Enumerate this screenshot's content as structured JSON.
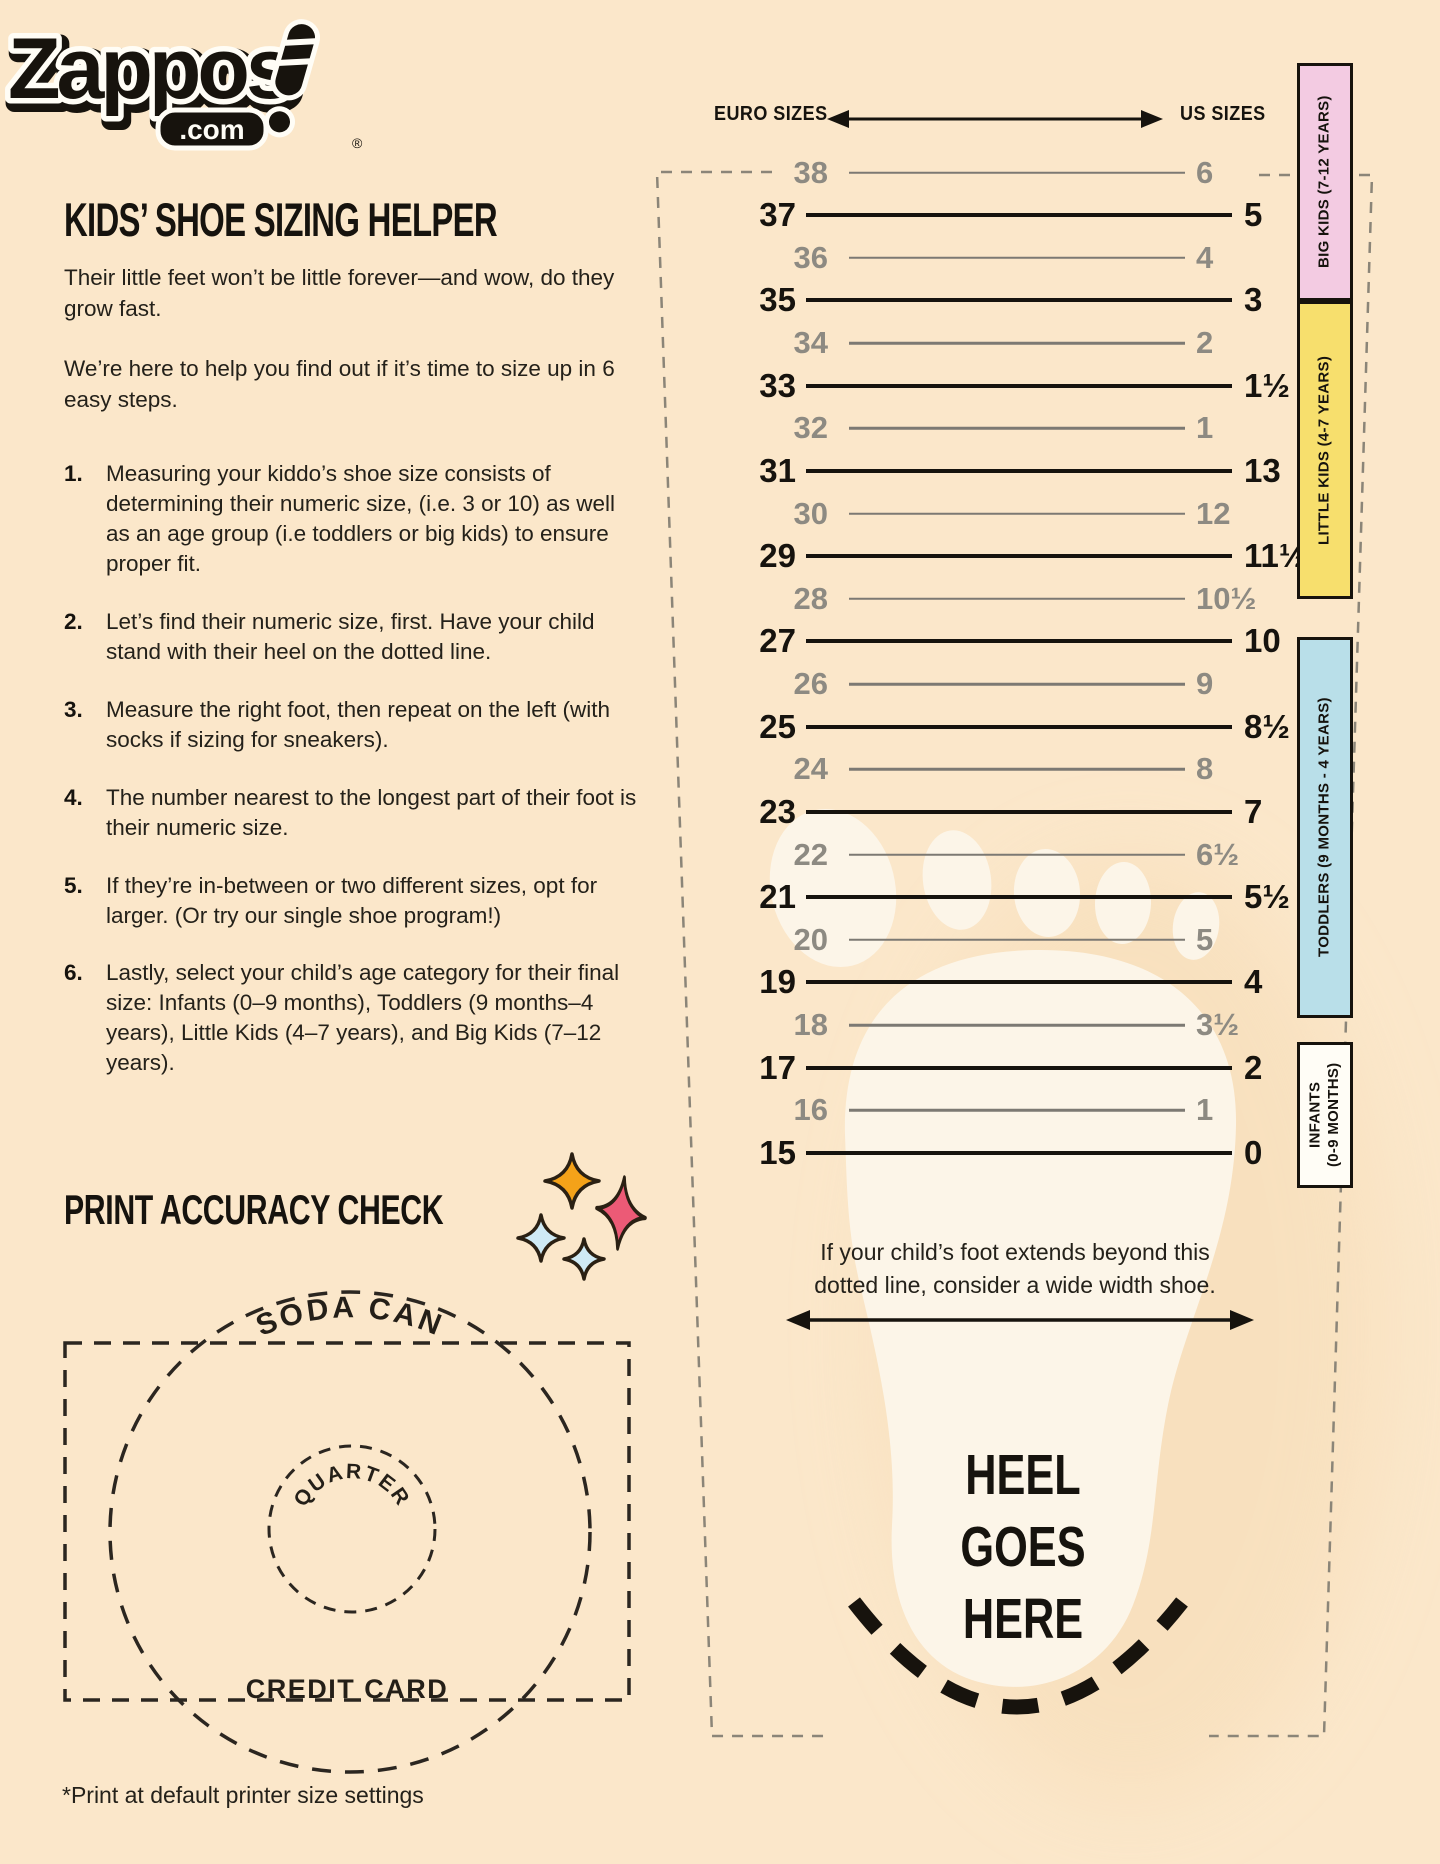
{
  "page": {
    "background": "#fbe7ca",
    "ink": "#16130e"
  },
  "logo": {
    "brand": "Zappos",
    "tld": ".com",
    "registered": "®"
  },
  "header": {
    "title": "KIDS’ SHOE SIZING HELPER"
  },
  "intro": {
    "p1": "Their little feet won’t be little forever—and wow, do they\ngrow fast.",
    "p2": "We’re here to help you find out if it’s time to size up in 6\neasy steps."
  },
  "steps": [
    {
      "num": "1.",
      "text": "Measuring your kiddo’s shoe size consists of\ndetermining their numeric size, (i.e. 3 or 10) as well\nas an age group (i.e toddlers or big kids) to ensure\nproper fit."
    },
    {
      "num": "2.",
      "text": "Let’s find their numeric size, first. Have your child\nstand with their heel on the dotted line."
    },
    {
      "num": "3.",
      "text": "Measure the right foot, then repeat on the left (with\nsocks if sizing for sneakers)."
    },
    {
      "num": "4.",
      "text": "The number nearest to the longest part of their foot is\ntheir numeric size."
    },
    {
      "num": "5.",
      "text": "If they’re in-between or two different sizes, opt for\nlarger. (Or try our single shoe program!)"
    },
    {
      "num": "6.",
      "text": "Lastly, select your child’s age category for their final\nsize: Infants (0–9 months), Toddlers (9 months–4\nyears), Little Kids (4–7 years), and Big Kids (7–12\nyears)."
    }
  ],
  "print_check": {
    "heading": "PRINT ACCURACY CHECK",
    "soda_label": "SODA CAN",
    "quarter_label": "QUARTER",
    "card_label": "CREDIT CARD"
  },
  "sparkles": [
    {
      "name": "sparkle-orange",
      "color": "#f4a219"
    },
    {
      "name": "sparkle-pink",
      "color": "#ec5a76"
    },
    {
      "name": "sparkle-light-blue",
      "color": "#cfeaf5"
    },
    {
      "name": "sparkle-light-blue-small",
      "color": "#cfeaf5"
    }
  ],
  "footnote": "*Print at default printer size settings",
  "ruler": {
    "euro_header": "EURO SIZES",
    "us_header": "US SIZES",
    "gray_color": "#8d8a82",
    "black_color": "#16130e",
    "rows": [
      {
        "euro": "38",
        "us": "6",
        "emphasis": false
      },
      {
        "euro": "37",
        "us": "5",
        "emphasis": true
      },
      {
        "euro": "36",
        "us": "4",
        "emphasis": false
      },
      {
        "euro": "35",
        "us": "3",
        "emphasis": true
      },
      {
        "euro": "34",
        "us": "2",
        "emphasis": false
      },
      {
        "euro": "33",
        "us": "1½",
        "emphasis": true
      },
      {
        "euro": "32",
        "us": "1",
        "emphasis": false
      },
      {
        "euro": "31",
        "us": "13",
        "emphasis": true
      },
      {
        "euro": "30",
        "us": "12",
        "emphasis": false
      },
      {
        "euro": "29",
        "us": "11½",
        "emphasis": true
      },
      {
        "euro": "28",
        "us": "10½",
        "emphasis": false
      },
      {
        "euro": "27",
        "us": "10",
        "emphasis": true
      },
      {
        "euro": "26",
        "us": "9",
        "emphasis": false
      },
      {
        "euro": "25",
        "us": "8½",
        "emphasis": true
      },
      {
        "euro": "24",
        "us": "8",
        "emphasis": false
      },
      {
        "euro": "23",
        "us": "7",
        "emphasis": true
      },
      {
        "euro": "22",
        "us": "6½",
        "emphasis": false
      },
      {
        "euro": "21",
        "us": "5½",
        "emphasis": true
      },
      {
        "euro": "20",
        "us": "5",
        "emphasis": false
      },
      {
        "euro": "19",
        "us": "4",
        "emphasis": true
      },
      {
        "euro": "18",
        "us": "3½",
        "emphasis": false
      },
      {
        "euro": "17",
        "us": "2",
        "emphasis": true
      },
      {
        "euro": "16",
        "us": "1",
        "emphasis": false
      },
      {
        "euro": "15",
        "us": "0",
        "emphasis": true
      }
    ],
    "bands": [
      {
        "label": "BIG KIDS (7-12 YEARS)",
        "color": "#f3cbe2"
      },
      {
        "label": "LITTLE KIDS (4-7 YEARS)",
        "color": "#f7df6d"
      },
      {
        "label": "TODDLERS (9 MONTHS - 4 YEARS)",
        "color": "#b9dfe9"
      },
      {
        "label": "INFANTS\n(0-9 MONTHS)",
        "color": "#fffdf6"
      }
    ],
    "wide_note": "If your child’s foot extends beyond this\ndotted line, consider a wide width shoe.",
    "heel_text": "HEEL\nGOES\nHERE"
  }
}
